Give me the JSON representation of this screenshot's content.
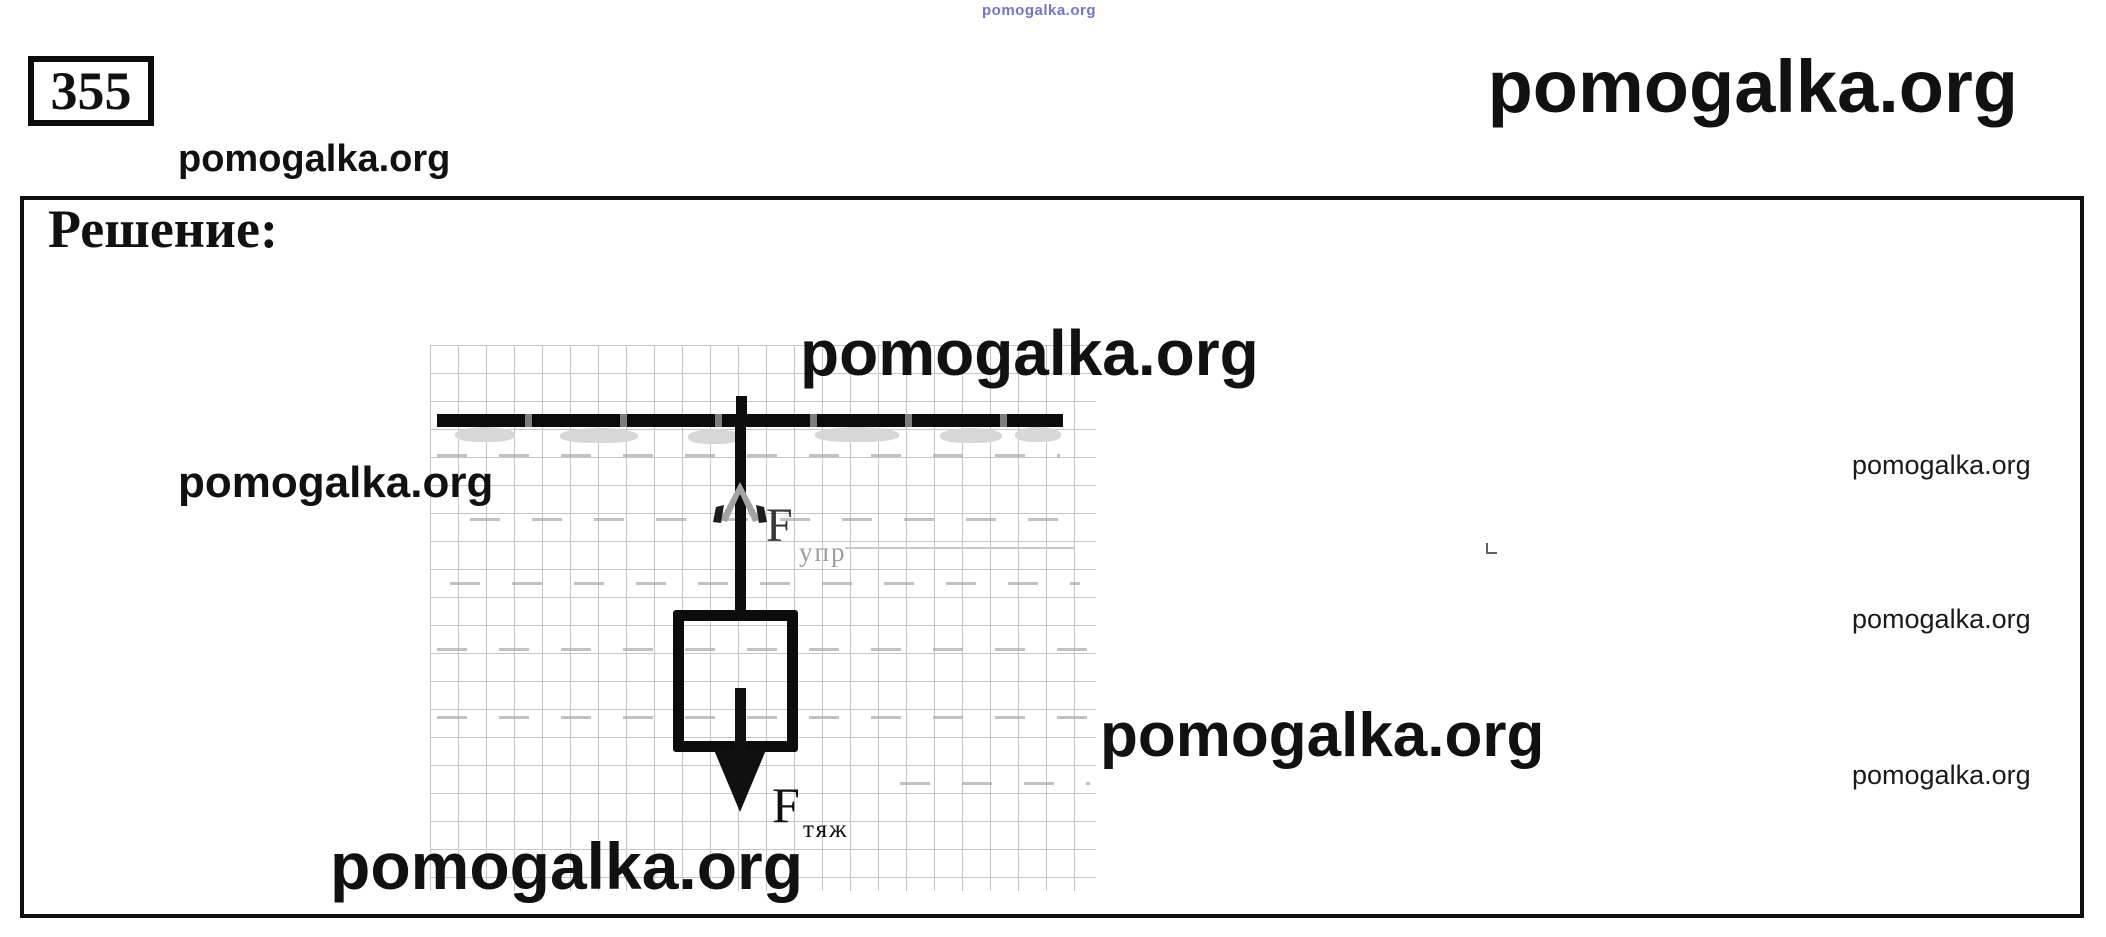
{
  "header": {
    "problem_number": "355",
    "watermark_small_blue": "pomogalka.org",
    "watermark_top_right": "pomogalka.org",
    "watermark_under_number": "pomogalka.org"
  },
  "solution": {
    "heading": "Решение:"
  },
  "watermarks": {
    "left_mid": "pomogalka.org",
    "diagram_top": "pomogalka.org",
    "diagram_bottom": "pomogalka.org",
    "mid_right": "pomogalka.org",
    "right_1": "pomogalka.org",
    "right_2": "pomogalka.org",
    "right_3": "pomogalka.org"
  },
  "diagram": {
    "elastic_force": {
      "symbol": "F",
      "subscript": "упр"
    },
    "gravity_force": {
      "symbol": "F",
      "subscript": "тяж"
    }
  },
  "colors": {
    "ink": "#111111",
    "blue_watermark": "#3d3dc0",
    "grid_line": "#c6c6c6",
    "faded_gray": "#9e9e9e"
  }
}
